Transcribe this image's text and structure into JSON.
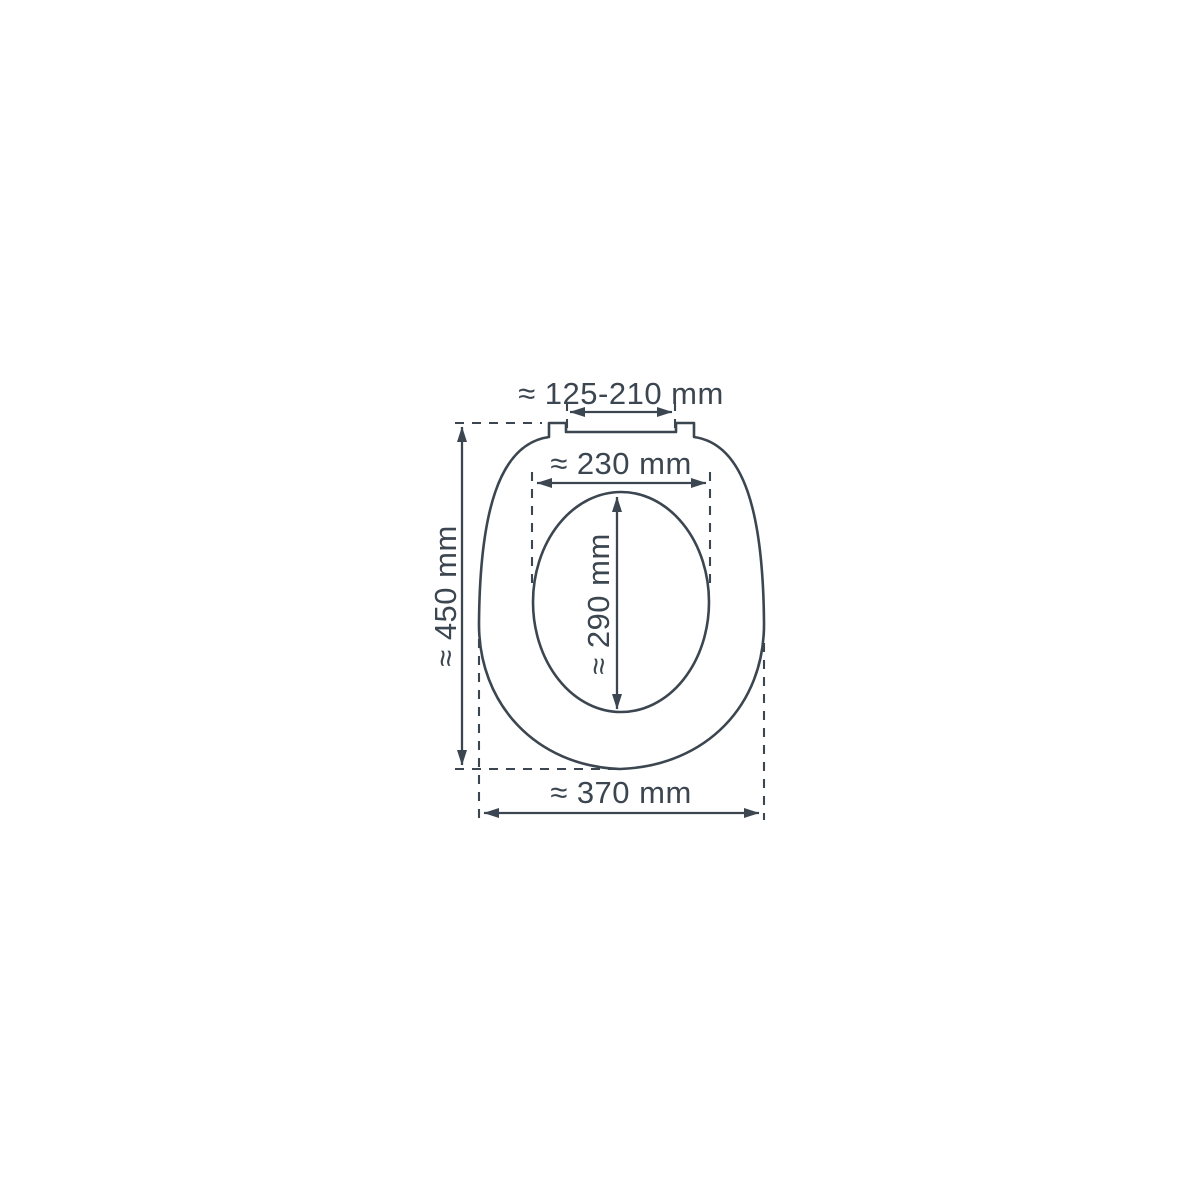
{
  "diagram": {
    "colors": {
      "line": "#3c4650",
      "background": "#ffffff"
    },
    "dimensions": {
      "hinge_width": {
        "label": "≈ 125-210 mm"
      },
      "opening_width": {
        "label": "≈ 230 mm"
      },
      "opening_depth": {
        "label": "≈ 290 mm"
      },
      "overall_depth": {
        "label": "≈ 450 mm"
      },
      "overall_width": {
        "label": "≈ 370 mm"
      }
    }
  }
}
